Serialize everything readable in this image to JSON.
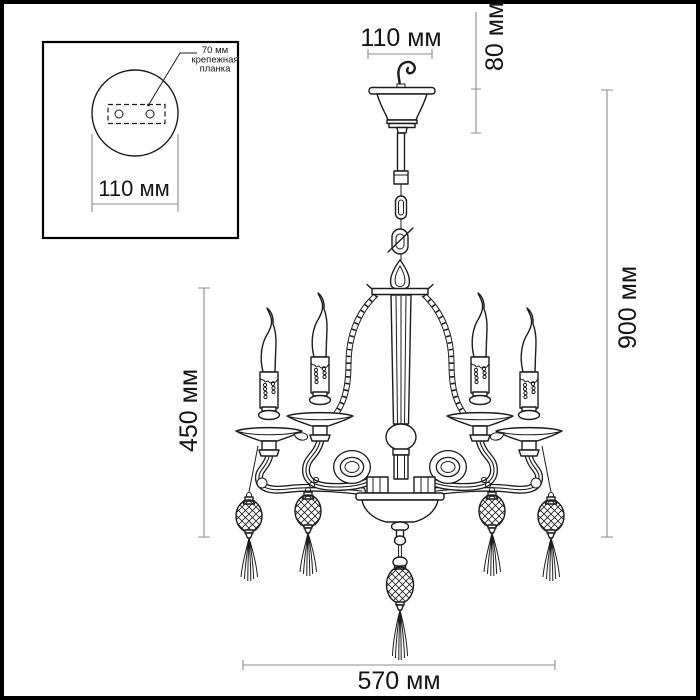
{
  "figure": {
    "background": "#ffffff",
    "frame_color": "#000000",
    "line_color": "#1c1c1c",
    "dim_line_color": "#8c8c8c",
    "text_color": "#151515"
  },
  "inset": {
    "mount_label": [
      "70 мм",
      "крепежная",
      "планка"
    ],
    "canopy_diameter": "110 мм"
  },
  "dimensions": {
    "canopy_width": "110 мм",
    "canopy_height": "80 мм",
    "overall_height": "900 мм",
    "body_height": "450 мм",
    "overall_width": "570 мм"
  }
}
